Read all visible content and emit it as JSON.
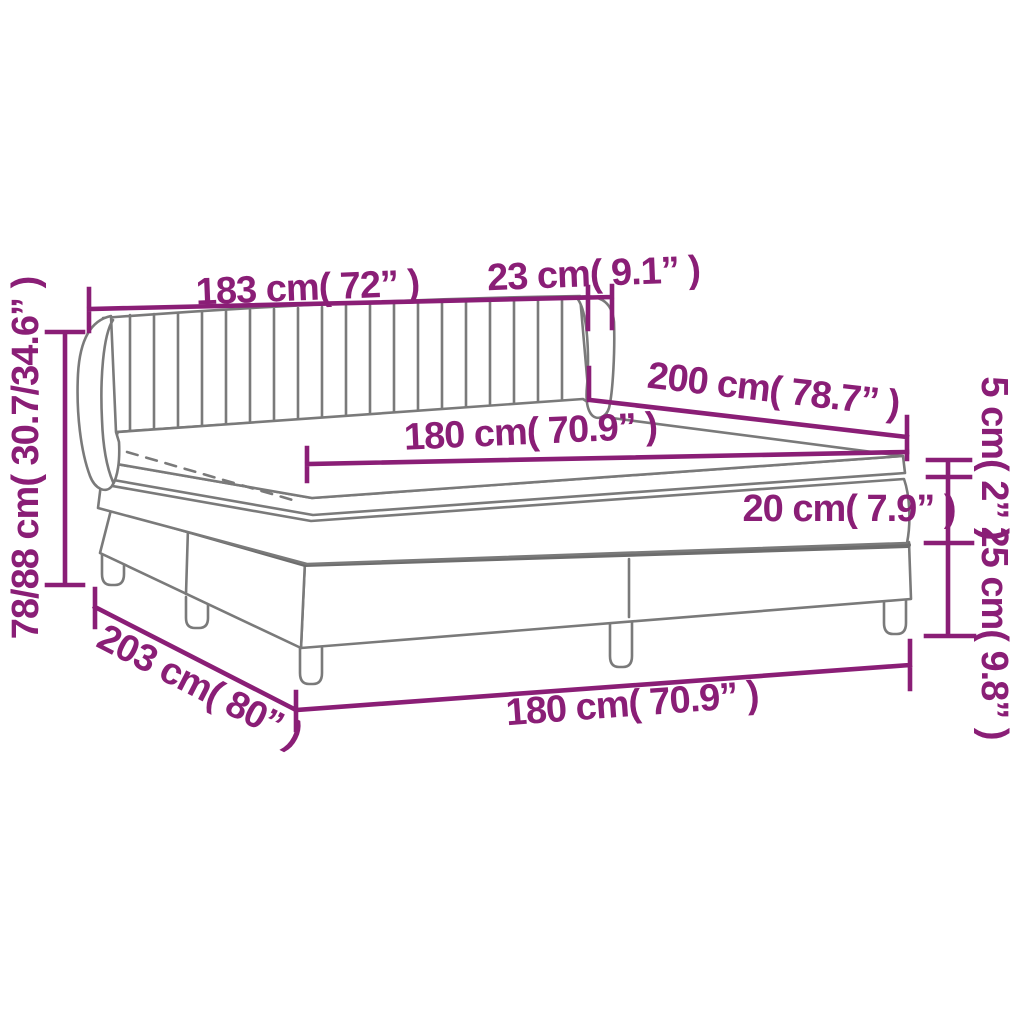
{
  "figure": {
    "title": "Box spring bed dimension diagram",
    "background_color": "#ffffff",
    "accent_color": "#8A1E76",
    "outline_color": "#7a7a7a"
  },
  "dims": {
    "headboard_width": "183 cm( 72” )",
    "headboard_side_depth": "23 cm( 9.1” )",
    "bed_length": "200 cm( 78.7” )",
    "mattress_width": "180 cm( 70.9” )",
    "topper_height": "5 cm( 2” )",
    "mattress_height": "20 cm( 7.9” )",
    "base_height": "25 cm( 9.8” )",
    "total_height": "78/88 cm( 30.7/34.6” )",
    "frame_length": "203 cm( 80” )",
    "mattress_width_bottom": "180 cm( 70.9” )"
  }
}
